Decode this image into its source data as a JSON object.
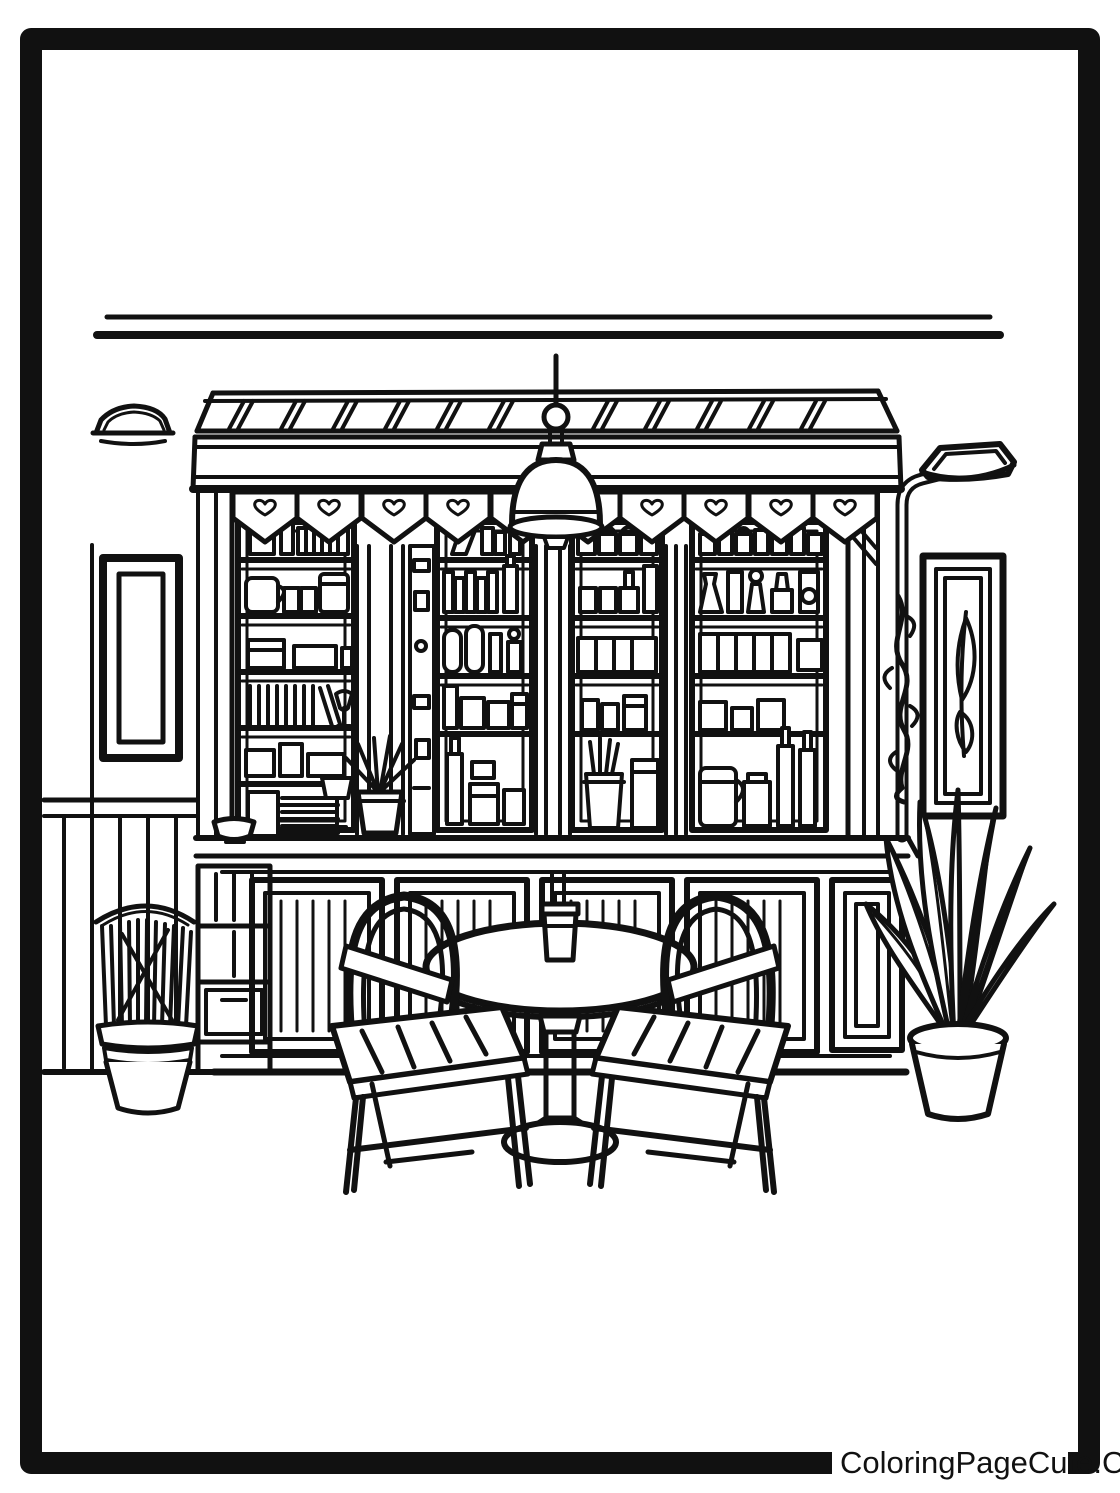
{
  "page": {
    "type_label": "coloring-page",
    "background_color": "#ffffff",
    "line_color": "#111111",
    "watermark_text": "ColoringPageCute.Com"
  },
  "scene": {
    "title": "Cafe bar interior line-art coloring page",
    "objects": [
      "ceiling-lines",
      "striped-awning",
      "scalloped-valance-with-hearts",
      "pendant-lamp",
      "left-wall-sconce",
      "right-curved-lamp",
      "left-empty-picture-frame",
      "right-leaf-picture-frame",
      "back-bar-shelves-with-bottles-jars-books",
      "striped-pilasters",
      "counter",
      "lower-cabinet-panels",
      "plate-stack",
      "bowl",
      "small-counter-plant",
      "cubby-shelf",
      "tall-basket-planter",
      "hanging-vine",
      "large-potted-plant",
      "round-pedestal-table",
      "cup-on-table",
      "left-chair",
      "right-chair",
      "wainscot-wall",
      "border-frame"
    ],
    "counts": {
      "valance_pennants": 10,
      "glass_shelf_sections": 4,
      "chairs": 2,
      "picture_frames": 2,
      "wall_lamps": 2,
      "plants": 3
    }
  }
}
